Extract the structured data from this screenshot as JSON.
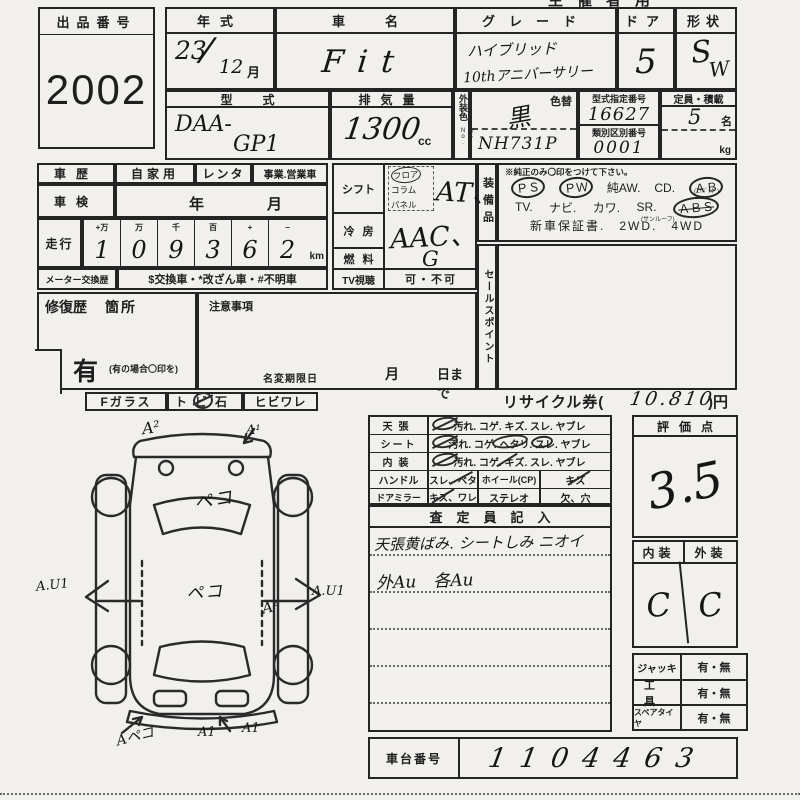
{
  "page": {
    "corner_text": "主催者用"
  },
  "exhibit": {
    "label": "出品番号",
    "number": "2002"
  },
  "top": {
    "year": {
      "label": "年式",
      "value": "23",
      "month": "12",
      "month_unit": "月"
    },
    "name": {
      "label": "車名",
      "value": "Fit"
    },
    "grade": {
      "label": "グレード",
      "line1": "ハイブリッド",
      "line2": "10thアニバーサリー"
    },
    "door": {
      "label": "ドア",
      "value": "5"
    },
    "shape": {
      "label": "形状",
      "value_s": "S",
      "value_w": "W"
    },
    "model": {
      "label": "型式",
      "prefix": "DAA-",
      "value": "GP1"
    },
    "disp": {
      "label": "排気量",
      "value": "1300",
      "unit": "cc"
    },
    "color": {
      "label": "外装色",
      "label2": "カラーNo.",
      "change_label": "色替",
      "value": "黒",
      "color_no": "NH731P"
    },
    "type_no": {
      "label": "型式指定番号",
      "value": "16627",
      "label2": "類別区別番号",
      "value2": "0001"
    },
    "capacity": {
      "label": "定員・積載",
      "value": "5",
      "unit": "名",
      "kg": "kg"
    }
  },
  "history": {
    "rireki": {
      "label": "車歴",
      "opt1": "自家用",
      "opt2": "レンタ",
      "opt3": "事業.営業車"
    },
    "shaken": {
      "label": "車検",
      "year": "年",
      "month": "月"
    },
    "mileage": {
      "label": "走行",
      "cols": [
        "+万",
        "万",
        "千",
        "百",
        "+",
        "−"
      ],
      "digits": [
        "1",
        "0",
        "9",
        "3",
        "6",
        "2"
      ],
      "unit": "km"
    },
    "meter": {
      "label": "メーター交換歴",
      "options": "$交換車・*改ざん車・#不明車"
    }
  },
  "repair": {
    "label": "修復歴",
    "label2": "箇所",
    "yes": "有",
    "note": "(有の場合〇印を)"
  },
  "caution": {
    "label": "注意事項",
    "rename_label": "名変期限日",
    "month": "月",
    "day": "日まで"
  },
  "spec": {
    "shift": {
      "label": "シフト",
      "opts": [
        "フロア",
        "コラム",
        "パネル"
      ],
      "value": "AT、"
    },
    "ac": {
      "label": "冷房",
      "value": "AAC、"
    },
    "fuel": {
      "label": "燃料",
      "value": "G"
    },
    "tv": {
      "label": "TV視聴",
      "value": "可・不可"
    }
  },
  "equip": {
    "label": "装備品",
    "note": "※純正のみ〇印をつけて下さい。",
    "r1": [
      "ＰＳ",
      "ＰＷ",
      "純AW.",
      "CD.",
      "ＡＢ"
    ],
    "r1sub": "(ｴｱﾊﾞｯｸﾞ)",
    "r2": [
      "TV.",
      "ナビ.",
      "カワ.",
      "SR.",
      "ＡＢＳ"
    ],
    "r2sub": "(サンルーフ)",
    "r3": "新車保証書.　2WD.　4WD"
  },
  "sales": {
    "label": "セールスポイント"
  },
  "glass": {
    "f": "Fガラス",
    "tobi": "トビ石",
    "hibi": "ヒビワレ"
  },
  "recycle": {
    "label": "リサイクル券(",
    "value": "10.810",
    "suffix": ")円"
  },
  "condition": {
    "r1": {
      "label": "天張",
      "options": "汚れ. コゲ. キズ. スレ. ヤブレ"
    },
    "r2": {
      "label": "シート",
      "options": "汚れ. コゲ. ヘタリ. スレ. ヤブレ"
    },
    "r3": {
      "label": "内装",
      "options": "汚れ. コゲ. キズ. スレ. ヤブレ"
    },
    "r4": {
      "label": "ハンドル",
      "value": "スレ、ベタ",
      "label2": "ホイール(CP)",
      "value2": "キズ"
    },
    "r5": {
      "label": "ドアミラー",
      "value": "キズ、ワレ",
      "label2": "ステレオ",
      "value2": "欠、穴"
    }
  },
  "inspector": {
    "header": "査定員記入",
    "line1": "天張黄ばみ. シートしみ ニオイ",
    "line2": "外Au　各Au"
  },
  "score": {
    "label": "評価点",
    "value": "3.5"
  },
  "intext": {
    "int_label": "内装",
    "ext_label": "外装",
    "int_value": "C",
    "ext_value": "C"
  },
  "tools": {
    "r1": {
      "label": "ジャッキ",
      "value": "有・無"
    },
    "r2": {
      "label": "工具",
      "value": "有・無"
    },
    "r3": {
      "label": "スペアタイヤ",
      "value": "有・無"
    }
  },
  "chassis": {
    "label": "車台番号",
    "value": "1104463"
  },
  "diagram": {
    "m_top_left": "A²",
    "m_top_right": "A¹",
    "m_hood": "ペコ",
    "m_center": "ペコ",
    "m_left": "A.U1",
    "m_right": "A.U1",
    "m_rear_door": "A²",
    "m_bottom1": "Aペコ",
    "m_bottom2": "A1",
    "m_bottom3": "A1"
  }
}
